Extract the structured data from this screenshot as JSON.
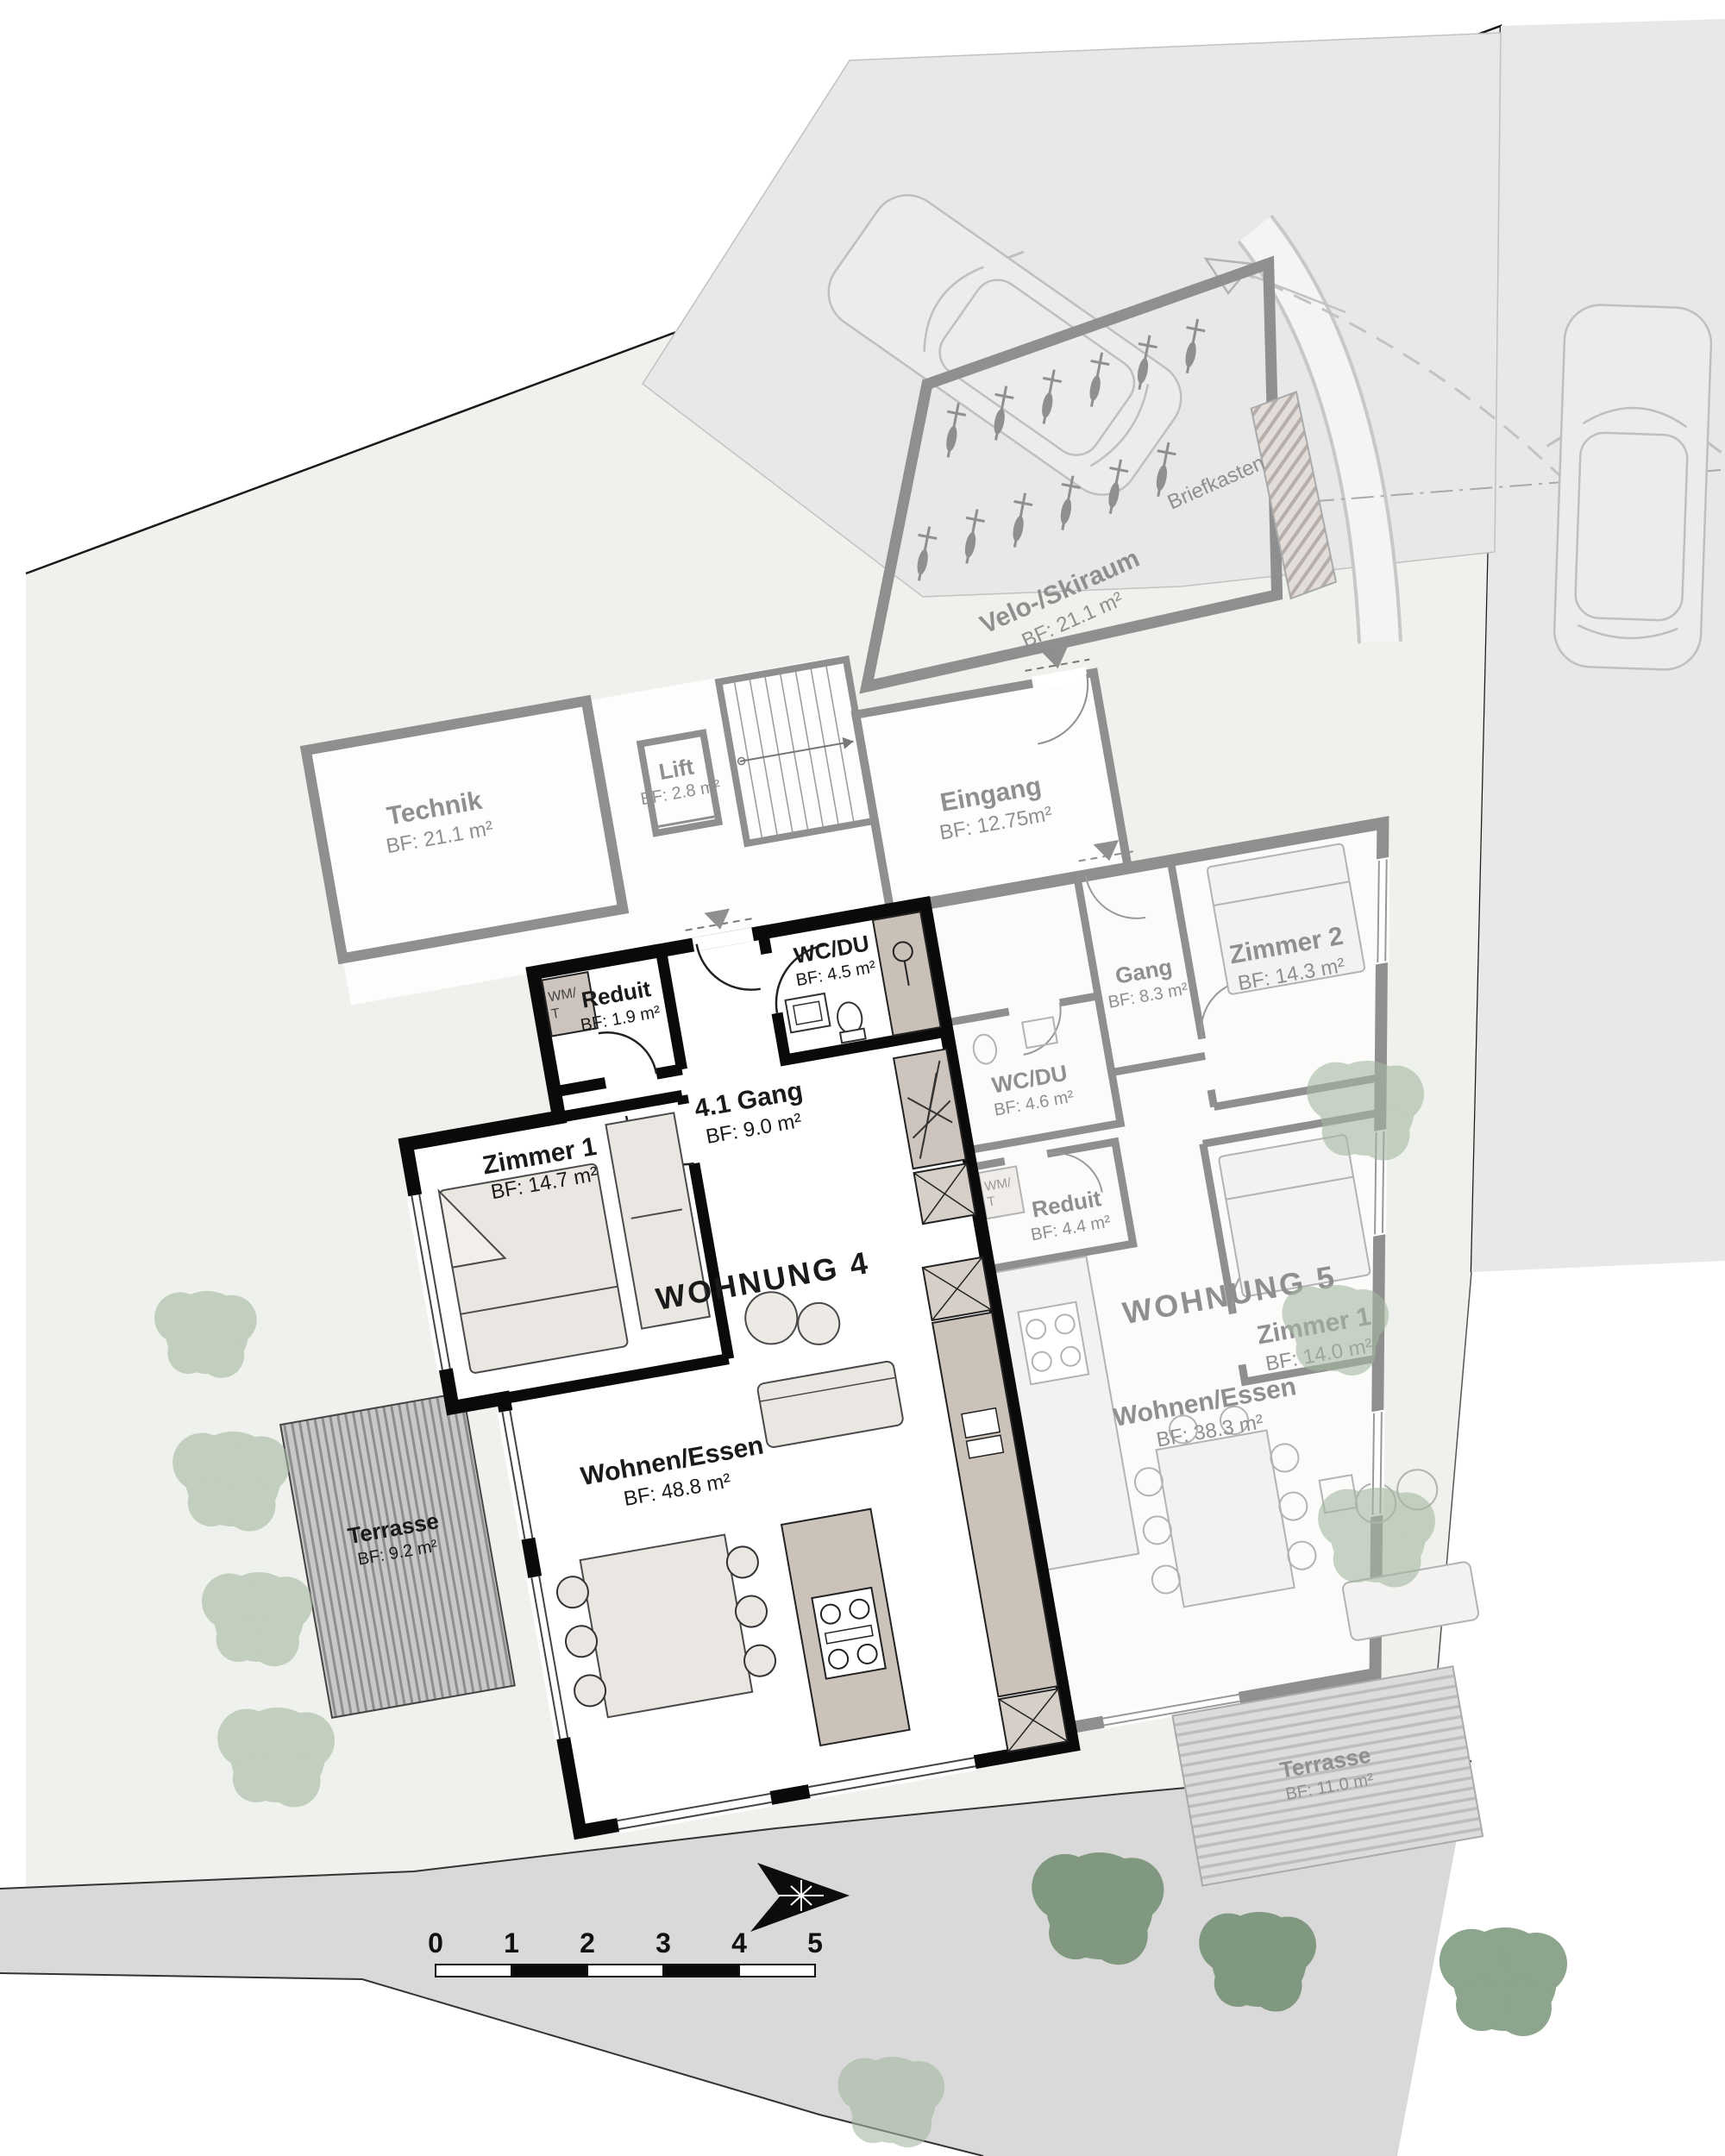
{
  "plan": {
    "common": {
      "velo": {
        "name": "Velo-/Skiraum",
        "area": "BF: 21.1 m²"
      },
      "technik": {
        "name": "Technik",
        "area": "BF: 21.1 m²"
      },
      "lift": {
        "name": "Lift",
        "area": "BF: 2.8 m²"
      },
      "eingang": {
        "name": "Eingang",
        "area": "BF: 12.75m²"
      },
      "briefkasten": "Briefkasten"
    },
    "w4": {
      "title": "WOHNUNG 4",
      "reduit": {
        "name": "Reduit",
        "area": "BF: 1.9 m²"
      },
      "wm1": "WM/",
      "wm2": "T",
      "gang": {
        "name": "4.1 Gang",
        "area": "BF: 9.0 m²"
      },
      "wcdu": {
        "name": "WC/DU",
        "area": "BF: 4.5 m²"
      },
      "zimmer1": {
        "name": "Zimmer 1",
        "area": "BF: 14.7 m²"
      },
      "wohnen": {
        "name": "Wohnen/Essen",
        "area": "BF: 48.8 m²"
      },
      "terrasse": {
        "name": "Terrasse",
        "area": "BF: 9.2 m²"
      }
    },
    "w5": {
      "title": "WOHNUNG 5",
      "zimmer2": {
        "name": "Zimmer 2",
        "area": "BF: 14.3 m²"
      },
      "gang": {
        "name": "Gang",
        "area": "BF: 8.3 m²"
      },
      "wcdu": {
        "name": "WC/DU",
        "area": "BF: 4.6 m²"
      },
      "reduit": {
        "name": "Reduit",
        "area": "BF: 4.4 m²"
      },
      "wm1": "WM/",
      "wm2": "T",
      "zimmer1": {
        "name": "Zimmer 1",
        "area": "BF: 14.0 m²"
      },
      "wohnen": {
        "name": "Wohnen/Essen",
        "area": "BF: 38.3 m²"
      },
      "terrasse": {
        "name": "Terrasse",
        "area": "BF: 11.0 m²"
      }
    },
    "scale": {
      "labels": [
        "0",
        "1",
        "2",
        "3",
        "4",
        "5"
      ]
    },
    "colors": {
      "wall_highlight": "#0a0a0a",
      "wall_muted": "#8f8f8f",
      "site": "#eff1ec",
      "road": "#d9d9d9",
      "parking": "#e8e8e8",
      "taupe": "#cbc2ba",
      "deck_dark": "#c8c8c8",
      "deck_light": "#dcdcdc",
      "tree_sage": "#a3b7a0",
      "tree_dark": "#4f7350",
      "text_dark": "#1a1a1a",
      "text_muted": "#8f8f8f"
    }
  }
}
